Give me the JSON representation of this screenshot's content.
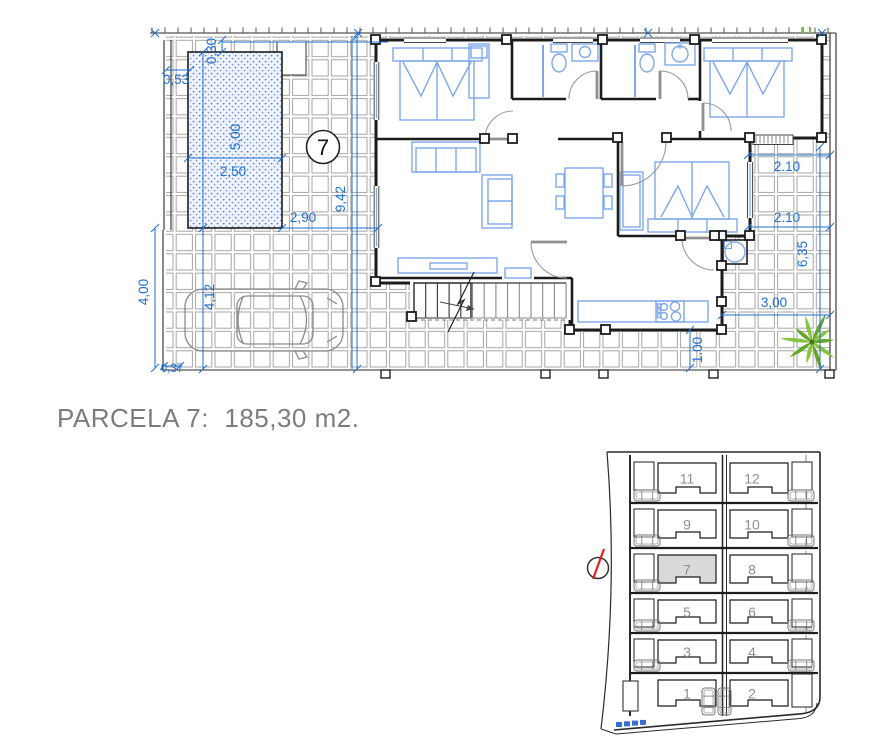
{
  "title": "PARCELA 7:  185,30 m2.",
  "colors": {
    "dimension_blue": "#1f6fd0",
    "furniture_blue": "#7fa8e8",
    "wall_black": "#1c1c1c",
    "grid_gray": "#a6a6a6",
    "palm_green": "#76b041",
    "title_gray": "#7c7c7c",
    "parcel_highlight": "#d9d9d9",
    "compass_red": "#e32121"
  },
  "floor_plan": {
    "parcel_number": "7",
    "dims": {
      "pool_top_offset": "0,30",
      "pool_left_offset": "0,53",
      "pool_length": "5,00",
      "pool_width": "2,50",
      "terrace_left_width": "2,90",
      "plot_depth": "9,42",
      "driveway_depth": "4,00",
      "parking_length": "4,12",
      "edge_offset": "0,37",
      "terrace_right_upper": "2.10",
      "terrace_right_lower": "2.10",
      "terrace_right_depth": "6,35",
      "terrace_back_width": "3,00",
      "walkway_width": "1.00"
    }
  },
  "site_plan": {
    "highlighted_parcel": "7",
    "rows": [
      {
        "left": "11",
        "right": "12"
      },
      {
        "left": "9",
        "right": "10"
      },
      {
        "left": "7",
        "right": "8"
      },
      {
        "left": "5",
        "right": "6"
      },
      {
        "left": "3",
        "right": "4"
      },
      {
        "left": "1",
        "right": "2"
      }
    ]
  }
}
